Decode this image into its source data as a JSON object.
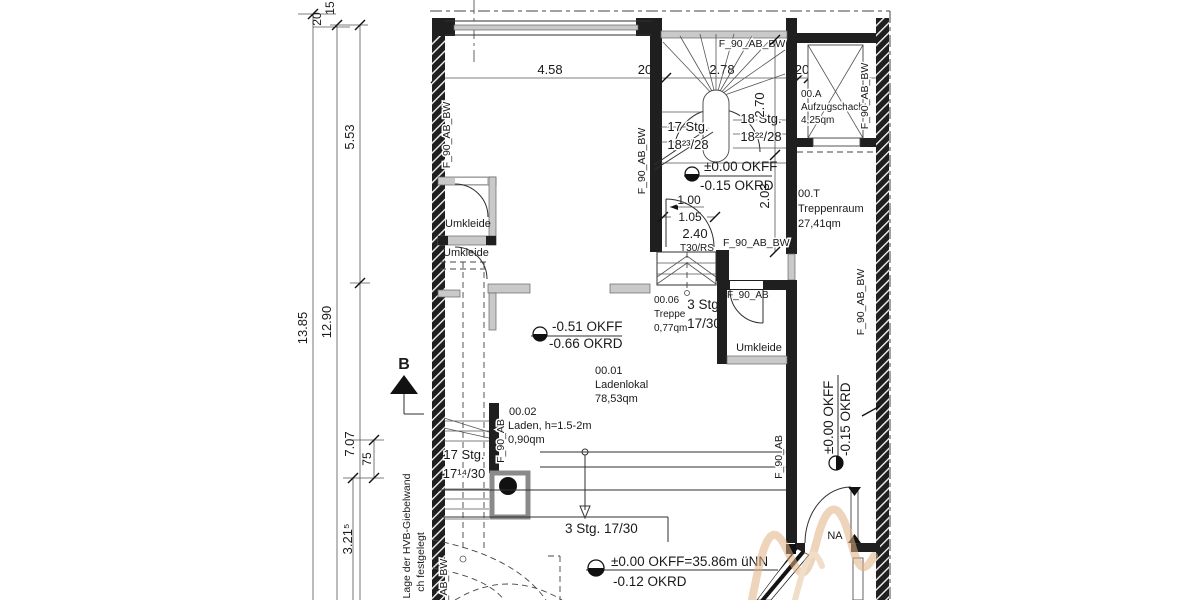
{
  "drawing": {
    "dims_top": [
      "4.58",
      "20",
      "2.78",
      "20",
      "1.70"
    ],
    "dims_left": {
      "d20": "20",
      "d15": "15",
      "d553": "5.53",
      "d1385": "13.85",
      "d1290": "12.90",
      "d707": "7.07",
      "d75": "75",
      "d3215": "3.21⁵"
    },
    "dims_vert": {
      "d270": "2.70",
      "d203": "2.03"
    },
    "door_dims": {
      "w": "1.00",
      "clear": "1.05",
      "h": "2.40",
      "type": "T30/RS"
    },
    "section_marker": "B",
    "rooms": {
      "ladenlokal": {
        "nr": "00.01",
        "name": "Ladenlokal",
        "area": "78,53qm"
      },
      "laden": {
        "nr": "00.02",
        "name": "Laden, h=1.5-2m",
        "area": "0,90qm"
      },
      "treppe": {
        "nr": "00.06",
        "name": "Treppe",
        "area": "0,77qm"
      },
      "aufzug": {
        "nr": "00.A",
        "name": "Aufzugschacht",
        "area": "4,25qm"
      },
      "treppenraum": {
        "nr": "00.T",
        "name": "Treppenraum",
        "area": "27,41qm"
      },
      "umkleide1": "Umkleide",
      "umkleide2": "Umkleide",
      "umkleide3": "Umkleide"
    },
    "stairs": {
      "main_left_1": "17 Stg.",
      "main_left_2": "18²³/28",
      "main_right_1": "18 Stg.",
      "main_right_2": "18²²/28",
      "lower_1": "17 Stg.",
      "lower_2": "17¹⁴/30",
      "steps3_a": "3 Stg",
      "steps3_b": "17/30",
      "steps3_long": "3 Stg. 17/30"
    },
    "levels": {
      "landing": {
        "ff": "±0.00 OKFF",
        "rd": "-0.15 OKRD"
      },
      "shop": {
        "ff": "-0.51 OKFF",
        "rd": "-0.66 OKRD"
      },
      "entry": {
        "ff": "±0.00 OKFF=35.86m üNN",
        "rd": "-0.12 OKRD"
      },
      "corridor": {
        "ff": "±0.00 OKFF",
        "rd": "-0.15 OKRD"
      }
    },
    "wall_labels": {
      "fab_bw": "F_90_AB_BW",
      "fab": "F_90_AB"
    },
    "notes": {
      "giebelwand1": "Lage der HVB-Giebelwand",
      "giebelwand2": "ch festgelegt",
      "na": "NA"
    }
  }
}
